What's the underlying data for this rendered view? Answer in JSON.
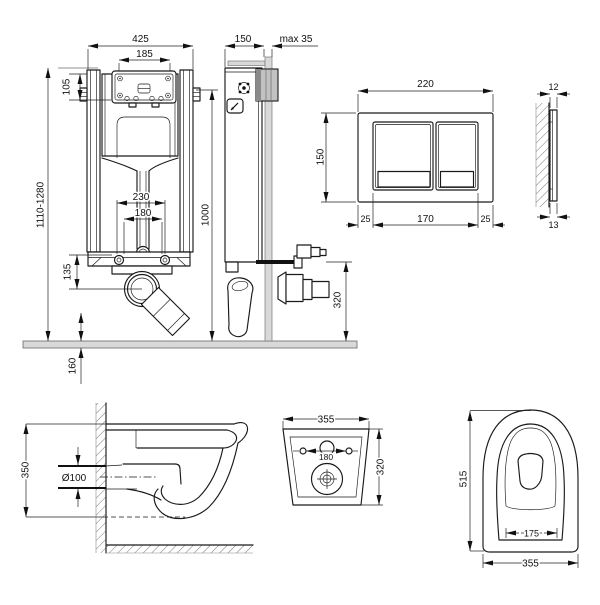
{
  "colors": {
    "line": "#1a1a1a",
    "gray_fill": "#d9d9d9",
    "plate_gray": "#c2c2c2",
    "accent_navy": "#2d2d6b"
  },
  "frame_front": {
    "width": "425",
    "access_width": "185",
    "access_height": "105",
    "stud_outer": "230",
    "stud_inner": "180",
    "outlet_drop": "135",
    "height_range": "1110-1280",
    "fixing_height": "1000",
    "floor_offset": "160"
  },
  "frame_side": {
    "depth": "150",
    "wall_max": "max 35",
    "outlet_height": "320"
  },
  "plate_front": {
    "width": "220",
    "height": "150",
    "margin_left": "25",
    "buttons_width": "170",
    "margin_right": "25"
  },
  "plate_side": {
    "thickness_top": "12",
    "thickness_bottom": "13"
  },
  "bowl_side": {
    "height": "350",
    "outlet_dia": "Ø100"
  },
  "bowl_back": {
    "width": "355",
    "height": "320",
    "hole_spacing": "180"
  },
  "bowl_top": {
    "depth": "515",
    "hole_spacing": "175",
    "width": "355"
  }
}
